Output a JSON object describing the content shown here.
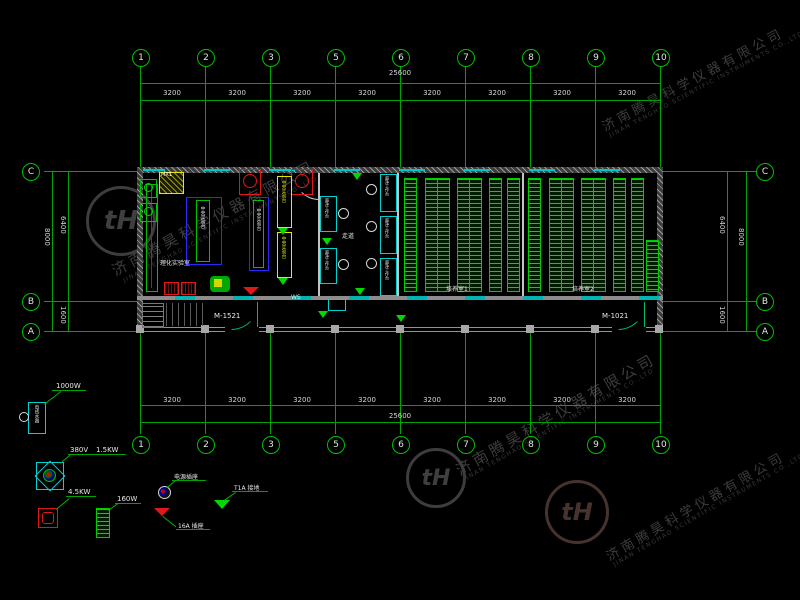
{
  "watermark": {
    "cn": "济南腾昊科学仪器有限公司",
    "en": "JINAN TENGHAO SCIENTIFIC INSTRUMENTS CO.,LTD",
    "logo_text": "tH"
  },
  "grid": {
    "columns": [
      "1",
      "2",
      "3",
      "5",
      "6",
      "7",
      "8",
      "9",
      "10"
    ],
    "rows": [
      "C",
      "B",
      "A"
    ]
  },
  "dims": {
    "total": "25600",
    "bay": "3200",
    "height_total": "8000",
    "height_upper": "6400",
    "height_lower": "1600"
  },
  "doors": {
    "left": "M-1521",
    "right": "M-1021"
  },
  "rooms": {
    "lab": "理化实验室",
    "corridor": "走道",
    "culture1": "培养室1",
    "culture2": "培养室2",
    "ws_label": "WS",
    "panel_label": "MX1"
  },
  "equipment": {
    "bench": "中央实验台",
    "clean_bench": "超净工作台",
    "heater": "电热水器"
  },
  "legend": {
    "heater_power": "1000W",
    "fan_voltage": "380V",
    "fan_power": "1.5KW",
    "sterilizer_power": "4.5KW",
    "rack_power": "160W",
    "socket_label": "电源插座",
    "socket16_label": "16A 插座",
    "ground_label": "T1A 接地"
  },
  "colors": {
    "grid_green": "#00a400",
    "wall_gray": "#9a9a9a",
    "window_cyan": "#00d2d2",
    "rack_green": "#00cc00",
    "bench_blue": "#2a2aff",
    "alert_red": "#e01818",
    "panel_yellow": "#e6e600"
  }
}
